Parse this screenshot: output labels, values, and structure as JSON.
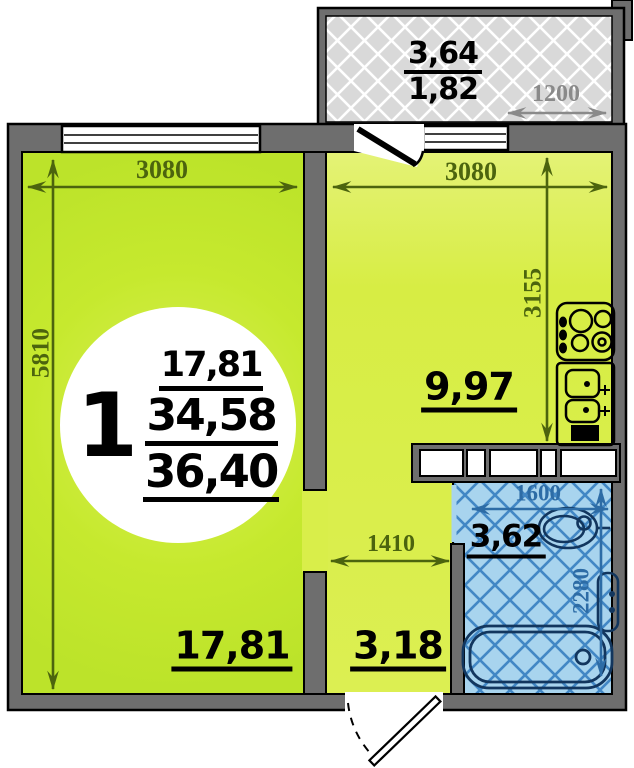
{
  "unit": {
    "number": "1",
    "living_area": "17,81",
    "total_area": "34,58",
    "overall_area": "36,40"
  },
  "rooms": {
    "living_room": {
      "area": "17,81",
      "width_mm": "3080",
      "height_mm": "5810"
    },
    "kitchen": {
      "area": "9,97",
      "width_mm": "3080",
      "height_mm": "3155"
    },
    "hallway": {
      "area": "3,18",
      "width_mm": "1410"
    },
    "bathroom": {
      "area": "3,62",
      "width_mm": "1600",
      "height_mm": "2280"
    },
    "balcony": {
      "area_full": "3,64",
      "area_reduced": "1,82",
      "width_mm": "1200"
    }
  },
  "colors": {
    "wall_gray": "#6e6e6e",
    "living_fill": "#c6e92e",
    "kitchen_fill": "#d9ee4a",
    "bathroom_fill": "#a8d4ee",
    "bathroom_lattice": "#4287c5",
    "balcony_fill": "#d9d9d9",
    "dim_green": "#4c640e",
    "dim_blue": "#2d6ca6",
    "dim_gray": "#8a8a8a",
    "fixture_navy": "#12365e"
  }
}
